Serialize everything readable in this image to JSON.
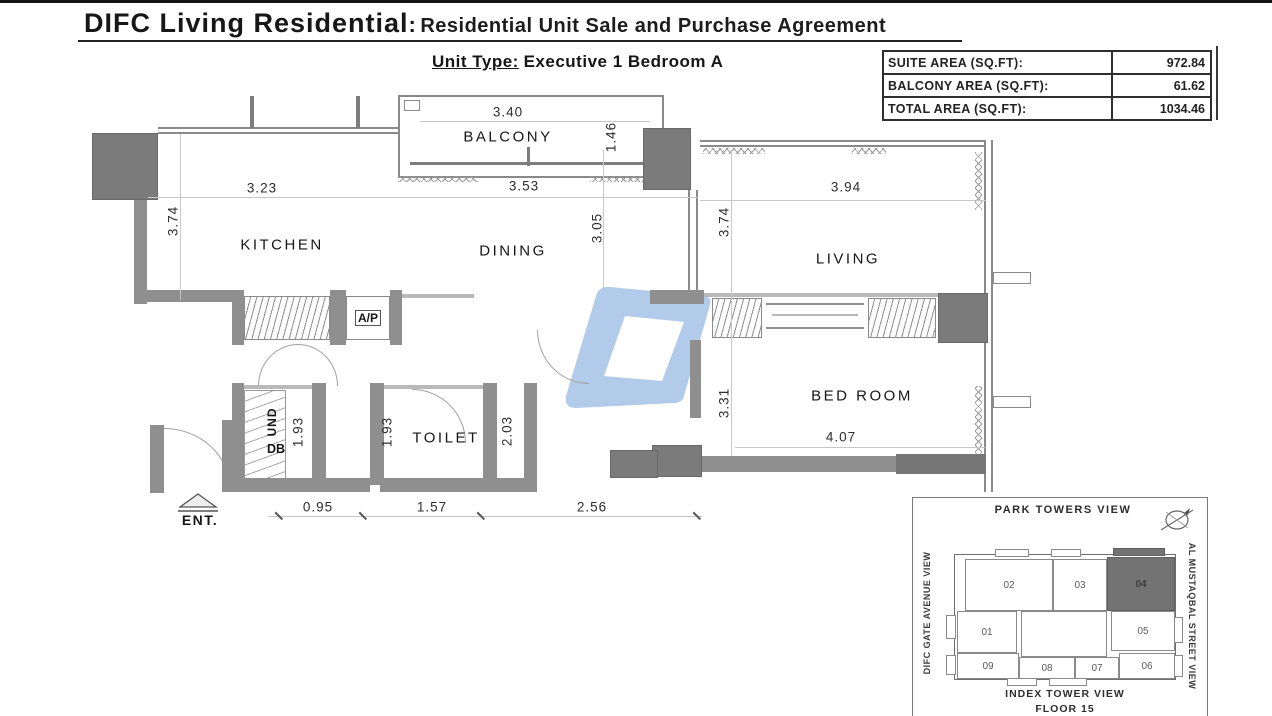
{
  "header": {
    "title_main": "DIFC Living Residential",
    "title_sep": ":",
    "title_sub": "Residential Unit Sale and Purchase Agreement"
  },
  "unit_type": {
    "label": "Unit Type:",
    "value": "Executive 1 Bedroom A"
  },
  "area_table": {
    "rows": [
      {
        "label": "SUITE AREA (SQ.FT):",
        "value": "972.84"
      },
      {
        "label": "BALCONY AREA (SQ.FT):",
        "value": "61.62"
      },
      {
        "label": "TOTAL AREA (SQ.FT):",
        "value": "1034.46"
      }
    ]
  },
  "plan": {
    "rooms": {
      "balcony": "BALCONY",
      "kitchen": "KITCHEN",
      "dining": "DINING",
      "living": "LIVING",
      "bedroom": "BED ROOM",
      "toilet": "TOILET",
      "ac_unit": "A/P",
      "entrance": "ENT.",
      "utility_vertical": "UND",
      "utility_db": "DB"
    },
    "dims": {
      "balcony_w": "3.40",
      "balcony_d": "1.46",
      "kitchen_w": "3.23",
      "dining_w": "3.53",
      "living_w": "3.94",
      "kitchen_d": "3.74",
      "dining_d": "3.05",
      "living_d": "3.74",
      "bedroom_d": "3.31",
      "bedroom_w": "4.07",
      "store_d": "1.93",
      "hall_d": "1.93",
      "toilet_d": "2.03",
      "entry_w": "0.95",
      "hall_w": "1.57",
      "toilet_w": "2.56"
    },
    "watermark_color": "#adc7e8"
  },
  "key_plan": {
    "top_label": "PARK TOWERS VIEW",
    "bottom_label_1": "INDEX TOWER VIEW",
    "bottom_label_2": "FLOOR 15",
    "left_label": "DIFC GATE AVENUE VIEW",
    "right_label": "AL MUSTAQBAL STREET VIEW",
    "units": [
      "01",
      "02",
      "03",
      "04",
      "05",
      "06",
      "07",
      "08",
      "09"
    ],
    "highlighted_unit": "04"
  }
}
